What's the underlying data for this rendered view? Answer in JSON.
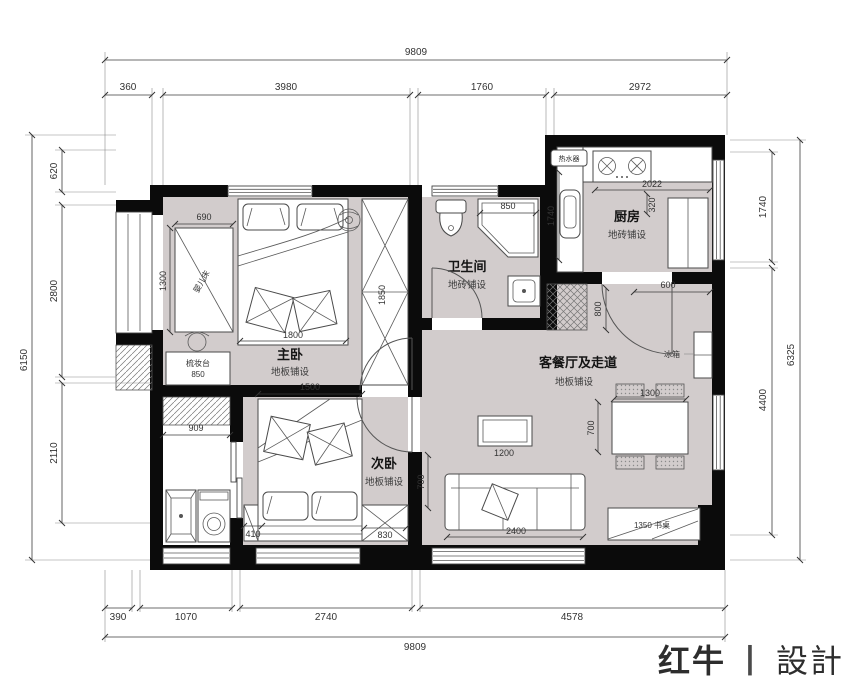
{
  "logo": {
    "brand": "红牛",
    "divider": "丨",
    "name": "設計"
  },
  "rooms": {
    "master": {
      "name": "主卧",
      "floor": "地板铺设"
    },
    "second": {
      "name": "次卧",
      "floor": "地板铺设"
    },
    "bath": {
      "name": "卫生间",
      "floor": "地砖铺设"
    },
    "kitchen": {
      "name": "厨房",
      "floor": "地砖铺设"
    },
    "living": {
      "name": "客餐厅及走道",
      "floor": "地板铺设"
    }
  },
  "labels": {
    "water_heater": "热水器",
    "crib": "婴儿床",
    "dresser": "梳妆台",
    "dresser_size": "850",
    "fridge": "冰箱",
    "desk": "1350 书桌"
  },
  "dims": {
    "top_overall": "9809",
    "top_a": "360",
    "top_b": "3980",
    "top_c": "1760",
    "top_d": "2972",
    "bottom_overall": "9809",
    "bottom_a": "390",
    "bottom_b": "1070",
    "bottom_c": "2740",
    "bottom_d": "4578",
    "left_overall": "6150",
    "left_a": "620",
    "left_b": "2800",
    "left_c": "2110",
    "right_overall": "6325",
    "right_a": "1740",
    "right_b": "4400",
    "crib_w": "690",
    "crib_h": "1300",
    "bed_master_w": "1800",
    "wardrobe_h": "1850",
    "balcony_w": "909",
    "bed_second_w": "1500",
    "nightstand_w": "410",
    "dresser2_w": "830",
    "door_second": "700",
    "shower_w": "850",
    "kitchen_counter_h": "1740",
    "kitchen_counter_w": "2022",
    "kitchen_depth": "320",
    "kitchen_gap": "600",
    "hall_w": "800",
    "dining_w": "1300",
    "dining_gap": "700",
    "coffee_w": "1200",
    "sofa_w": "2400"
  }
}
